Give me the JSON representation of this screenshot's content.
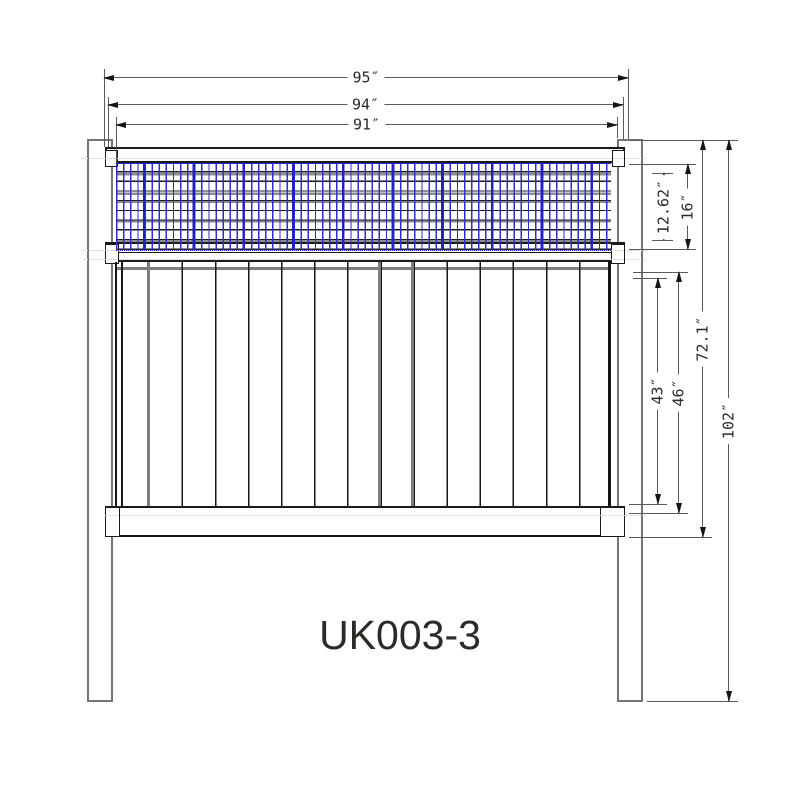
{
  "title": {
    "model_label": "UK003-3"
  },
  "drawing": {
    "type": "fence-panel-elevation",
    "description": "Front elevation of a fence panel with wire-mesh lattice topper, vertical pickets, two square posts and three horizontal rails",
    "dimensions_top": [
      {
        "label": "95″"
      },
      {
        "label": "94″"
      },
      {
        "label": "91″"
      }
    ],
    "dimensions_right": [
      {
        "label": "12.62″"
      },
      {
        "label": "16″"
      },
      {
        "label": "43″"
      },
      {
        "label": "46″"
      },
      {
        "label": "72.1″"
      },
      {
        "label": "102″"
      }
    ],
    "colors": {
      "line": "#1a1a1a",
      "post_gray": "#757575",
      "mesh_blue": "#2a2acb",
      "centerline": "#cccccc",
      "dimension": "#5a5a5a",
      "text": "#2a2a2a"
    }
  }
}
